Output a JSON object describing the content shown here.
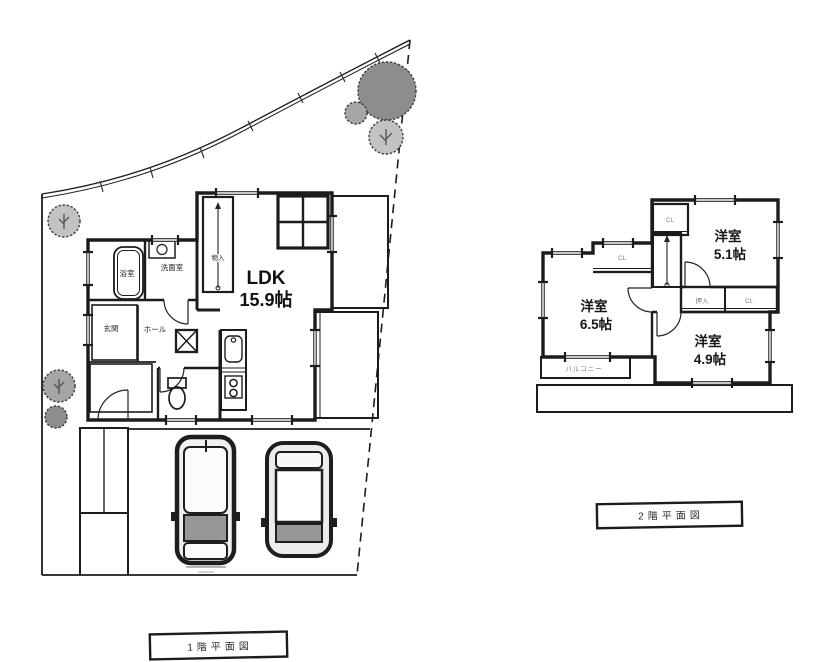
{
  "floor1": {
    "caption": "1階平面図",
    "ldk_label": "LDK",
    "ldk_area": "15.9帖",
    "bath": "浴室",
    "washroom": "洗面室",
    "entrance": "玄関",
    "hall": "ホール",
    "stair_storage": "物入"
  },
  "floor2": {
    "caption": "2階平面図",
    "room_a_label": "洋室",
    "room_a_area": "5.1帖",
    "room_b_label": "洋室",
    "room_b_area": "6.5帖",
    "room_c_label": "洋室",
    "room_c_area": "4.9帖",
    "balcony": "バルコニー",
    "closet_a": "CL",
    "closet_b": "CL",
    "closet_c": "CL",
    "oshiire": "押入"
  },
  "colors": {
    "ink": "#1c1c1c",
    "window_pane": "#c6c6c6",
    "tree_dark": "#8d8d8d",
    "tree_mid": "#a6a6a6",
    "tree_light": "#c2c2c2",
    "balcony_fill": "#d8d8d8",
    "tub_fill": "#d6d6d6",
    "car_glass": "#979797"
  }
}
